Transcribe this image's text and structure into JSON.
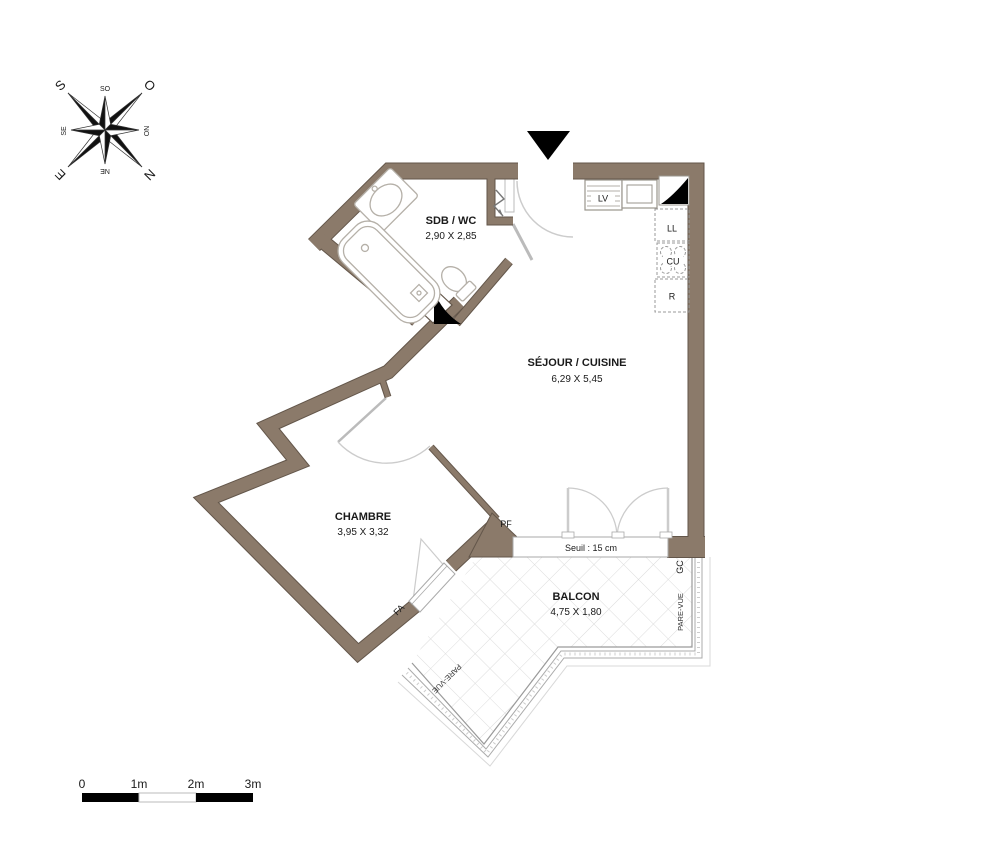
{
  "compass": {
    "s": "S",
    "o": "O",
    "n": "N",
    "e": "E",
    "so": "SO",
    "no": "NO",
    "ne": "NE",
    "se": "SE"
  },
  "rooms": {
    "sdb_name": "SDB / WC",
    "sdb_dims": "2,90 X 2,85",
    "sejour_name": "SÉJOUR / CUISINE",
    "sejour_dims": "6,29 X 5,45",
    "chambre_name": "CHAMBRE",
    "chambre_dims": "3,95 X 3,32",
    "balcon_name": "BALCON",
    "balcon_dims": "4,75 X 1,80"
  },
  "appliances": {
    "lv": "LV",
    "ll": "LL",
    "cu": "CU",
    "r": "R"
  },
  "openings": {
    "pf": "PF",
    "fa": "FA"
  },
  "threshold_label": "Seuil : 15 cm",
  "railing": {
    "gc": "GC",
    "pare_vue_right": "PARE-VUE",
    "pare_vue_diagonal": "PARE-VUE"
  },
  "scale_bar": {
    "labels": [
      "0",
      "1m",
      "2m",
      "3m"
    ]
  },
  "colors": {
    "wall": "#8B7A6A",
    "wall_outline": "#63564A",
    "fixture_line": "#b5b0a8",
    "tile_line": "#dcdcdc",
    "black": "#000000"
  }
}
